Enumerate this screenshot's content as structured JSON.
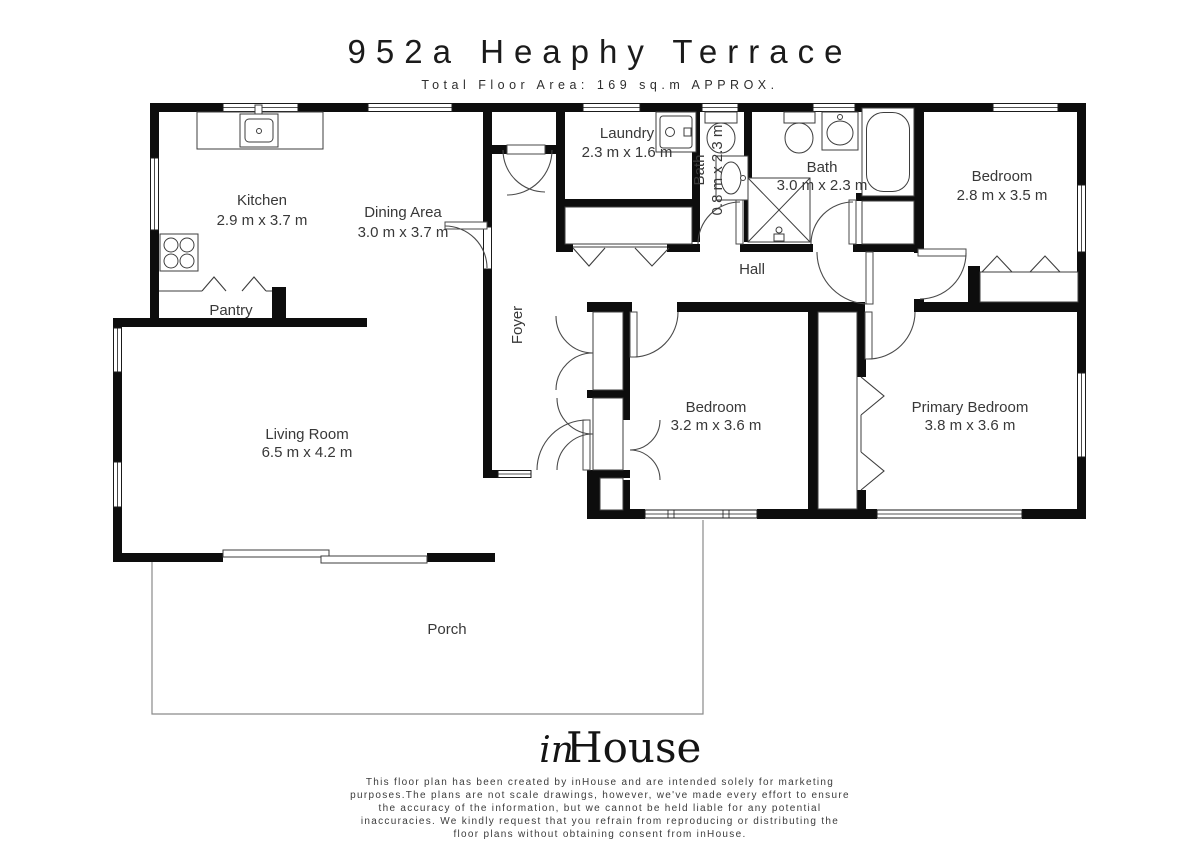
{
  "header": {
    "title": "952a Heaphy Terrace",
    "subtitle": "Total Floor Area: 169 sq.m APPROX."
  },
  "rooms": {
    "kitchen": {
      "name": "Kitchen",
      "dims": "2.9 m x 3.7 m"
    },
    "dining": {
      "name": "Dining Area",
      "dims": "3.0 m x 3.7 m"
    },
    "pantry": {
      "name": "Pantry"
    },
    "laundry": {
      "name": "Laundry",
      "dims": "2.3 m x 1.6 m"
    },
    "bath_small": {
      "name": "Bath",
      "dims": "0.8 m x 2.3 m"
    },
    "bath": {
      "name": "Bath",
      "dims": "3.0 m x 2.3 m"
    },
    "bedroom_top": {
      "name": "Bedroom",
      "dims": "2.8 m x 3.5 m"
    },
    "hall": {
      "name": "Hall"
    },
    "foyer": {
      "name": "Foyer"
    },
    "bedroom_mid": {
      "name": "Bedroom",
      "dims": "3.2 m x 3.6 m"
    },
    "primary": {
      "name": "Primary Bedroom",
      "dims": "3.8 m x 3.6 m"
    },
    "living": {
      "name": "Living Room",
      "dims": "6.5 m x 4.2 m"
    },
    "porch": {
      "name": "Porch"
    }
  },
  "footer": {
    "logo_script": "in",
    "logo_serif": "House",
    "disclaimer_lines": [
      "This floor plan has been created by inHouse and are intended solely for marketing",
      "purposes.The plans are not scale drawings, however, we've made every effort to ensure",
      "the accuracy of the information, but we cannot be held liable for any potential",
      "inaccuracies. We kindly request that you refrain from reproducing or distributing the",
      "floor plans without obtaining consent from inHouse."
    ]
  },
  "colors": {
    "wall": "#0d0d0d",
    "line": "#3d3d3d",
    "text": "#383838"
  }
}
